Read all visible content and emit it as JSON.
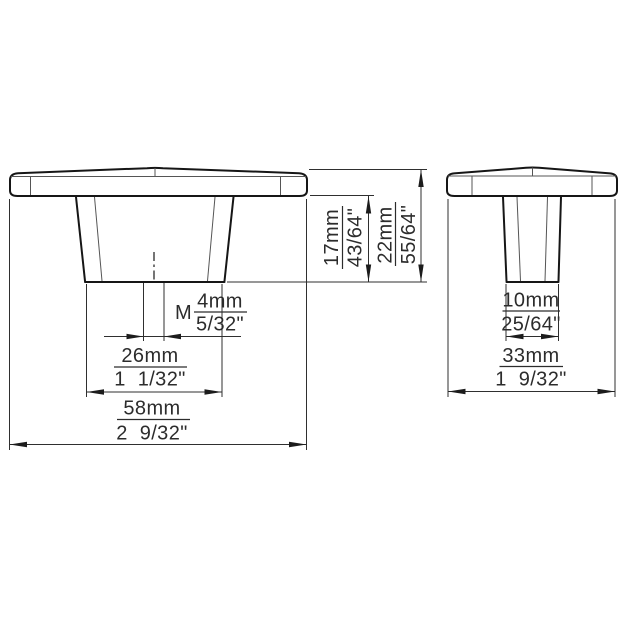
{
  "style": {
    "background": "#ffffff",
    "object_line_color": "#161616",
    "dimension_line_color": "#2f2f2f",
    "text_color": "#2c2c2c"
  },
  "front_view": {
    "thread": {
      "prefix": "M",
      "metric": "4mm",
      "imperial": "5/32\""
    },
    "neck_width": {
      "metric": "26mm",
      "imperial": "1  1/32\""
    },
    "overall_width": {
      "metric": "58mm",
      "imperial": "2  9/32\""
    },
    "neck_height": {
      "metric": "17mm",
      "imperial": "43/64\""
    },
    "overall_height": {
      "metric": "22mm",
      "imperial": "55/64\""
    }
  },
  "side_view": {
    "neck_width": {
      "metric": "10mm",
      "imperial": "25/64\""
    },
    "overall_depth": {
      "metric": "33mm",
      "imperial": "1  9/32\""
    }
  }
}
